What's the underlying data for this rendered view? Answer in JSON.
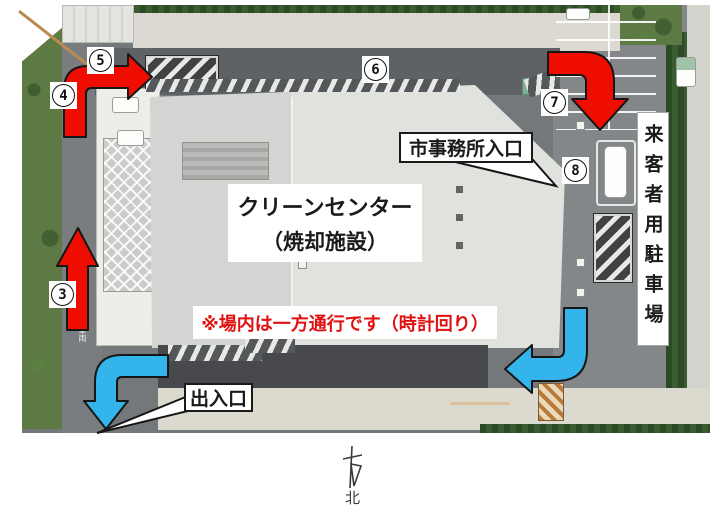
{
  "title_context": "clean-center-route-map",
  "colors": {
    "arrow_red": "#ee0d00",
    "arrow_blue": "#33b5ec",
    "notice_red": "#e01010"
  },
  "facility": {
    "line1": "クリーンセンター",
    "line2": "（焼却施設）"
  },
  "notice": "※場内は一方通行です（時計回り）",
  "labels": {
    "office_entrance": "市事務所入口",
    "gate": "出入口",
    "visitor_parking": "来客者用駐車場"
  },
  "markers": [
    {
      "label": "3"
    },
    {
      "label": "4"
    },
    {
      "label": "5"
    },
    {
      "label": "6"
    },
    {
      "label": "7"
    },
    {
      "label": "8"
    }
  ],
  "road_marking": "車両",
  "compass": "北"
}
